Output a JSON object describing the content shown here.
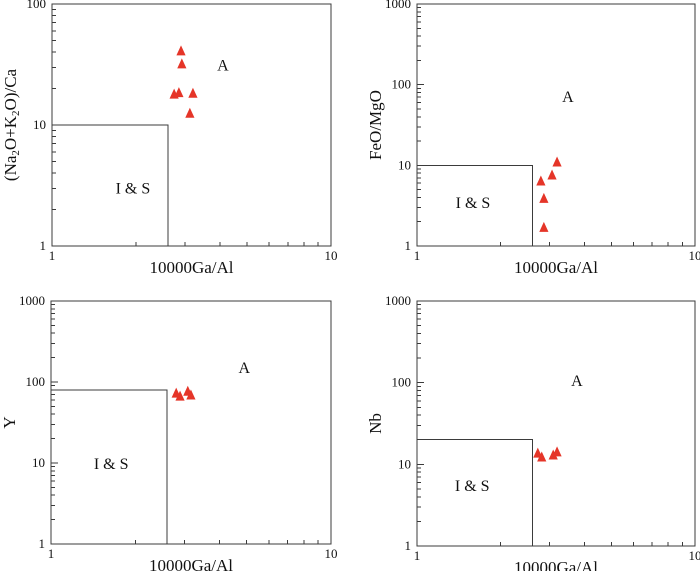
{
  "figure": {
    "background": "#ffffff",
    "line_color": "#3b3b3b",
    "text_color": "#111111",
    "marker_color": "#e53528"
  },
  "chart_data": [
    {
      "id": "top-left",
      "type": "scatter",
      "xlabel": "10000Ga/Al",
      "ylabel": "(Na₂O+K₂O)/Ca",
      "xscale": "log",
      "yscale": "log",
      "xlim": [
        1,
        10
      ],
      "ylim": [
        1,
        100
      ],
      "x_ticks": [
        1,
        10
      ],
      "y_ticks": [
        1,
        10,
        100
      ],
      "grid": false,
      "boundary": {
        "x": 2.6,
        "y": 10
      },
      "annotations": [
        {
          "text": "I & S",
          "x": 1.95,
          "y": 3.0
        },
        {
          "text": "A",
          "x": 4.1,
          "y": 31
        }
      ],
      "series": [
        {
          "name": "samples",
          "marker": "triangle-up",
          "color": "#e53528",
          "points": [
            [
              2.9,
              41
            ],
            [
              2.92,
              32
            ],
            [
              2.74,
              18
            ],
            [
              2.85,
              18.5
            ],
            [
              3.2,
              18.3
            ],
            [
              3.12,
              12.5
            ]
          ]
        }
      ]
    },
    {
      "id": "top-right",
      "type": "scatter",
      "xlabel": "10000Ga/Al",
      "ylabel": "FeO/MgO",
      "xscale": "log",
      "yscale": "log",
      "xlim": [
        1,
        10
      ],
      "ylim": [
        1,
        1000
      ],
      "x_ticks": [
        1,
        10
      ],
      "y_ticks": [
        1,
        10,
        100,
        1000
      ],
      "grid": false,
      "boundary": {
        "x": 2.6,
        "y": 10
      },
      "annotations": [
        {
          "text": "I & S",
          "x": 1.59,
          "y": 3.4
        },
        {
          "text": "A",
          "x": 3.49,
          "y": 70
        }
      ],
      "series": [
        {
          "name": "samples",
          "marker": "triangle-up",
          "color": "#e53528",
          "points": [
            [
              3.19,
              11
            ],
            [
              3.06,
              7.6
            ],
            [
              2.79,
              6.4
            ],
            [
              2.86,
              3.9
            ],
            [
              2.86,
              1.7
            ]
          ]
        }
      ]
    },
    {
      "id": "bottom-left",
      "type": "scatter",
      "xlabel": "10000Ga/Al",
      "ylabel": "Y",
      "xscale": "log",
      "yscale": "log",
      "xlim": [
        1,
        10
      ],
      "ylim": [
        1,
        1000
      ],
      "x_ticks": [
        1,
        10
      ],
      "y_ticks": [
        1,
        10,
        100,
        1000
      ],
      "grid": false,
      "boundary": {
        "x": 2.6,
        "y": 80
      },
      "annotations": [
        {
          "text": "I & S",
          "x": 1.64,
          "y": 9.7
        },
        {
          "text": "A",
          "x": 4.9,
          "y": 149
        }
      ],
      "series": [
        {
          "name": "samples",
          "marker": "triangle-up",
          "color": "#e53528",
          "points": [
            [
              2.8,
              73
            ],
            [
              2.89,
              67
            ],
            [
              3.08,
              77
            ],
            [
              3.16,
              69
            ]
          ]
        }
      ]
    },
    {
      "id": "bottom-right",
      "type": "scatter",
      "xlabel": "10000Ga/Al",
      "ylabel": "Nb",
      "xscale": "log",
      "yscale": "log",
      "xlim": [
        1,
        10
      ],
      "ylim": [
        1,
        1000
      ],
      "x_ticks": [
        1,
        10
      ],
      "y_ticks": [
        1,
        10,
        100,
        1000
      ],
      "grid": false,
      "boundary": {
        "x": 2.6,
        "y": 20
      },
      "annotations": [
        {
          "text": "I & S",
          "x": 1.58,
          "y": 5.4
        },
        {
          "text": "A",
          "x": 3.76,
          "y": 105
        }
      ],
      "series": [
        {
          "name": "samples",
          "marker": "triangle-up",
          "color": "#e53528",
          "points": [
            [
              2.72,
              13.7
            ],
            [
              2.81,
              12.3
            ],
            [
              3.09,
              13.0
            ],
            [
              3.19,
              14.2
            ]
          ]
        }
      ]
    }
  ]
}
